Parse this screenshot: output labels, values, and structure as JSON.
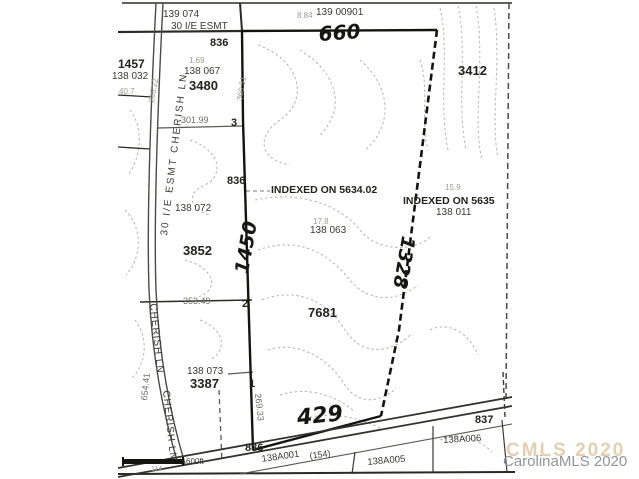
{
  "colors": {
    "ink": "#2b2b26",
    "faint_print": "#9b9b90",
    "contour": "#b4b4ab",
    "watermark_front": "#8f959c",
    "watermark_ghost": "#d0a769"
  },
  "watermark": {
    "ghost": "CMLS 2020",
    "front": "CarolinaMLS 2020"
  },
  "labels": {
    "tract_139_074": "139 074",
    "esmt_top": "30 I/E ESMT",
    "elev_836_top": "836",
    "dim_884": "8.84",
    "tract_139_00901": "139 00901",
    "parcel_1457": "1457",
    "tract_138_032": "138 032",
    "dim_40_7": "40.7",
    "dim_1_69": "1.69",
    "tract_138_067": "138 067",
    "parcel_3480": "3480",
    "parcel_3412": "3412",
    "dim_301_99": "301.99",
    "lot_3": "3",
    "elev_836_mid": "836",
    "indexed_5634": "INDEXED ON 5634.02",
    "dim_15_9": "15.9",
    "indexed_5635": "INDEXED ON 5635",
    "tract_138_011": "138 011",
    "tract_138_072": "138 072",
    "dim_17_8": "17.8",
    "tract_138_063": "138 063",
    "parcel_3852": "3852",
    "parcel_7681": "7681",
    "dim_353_49": "353.49",
    "lot_2": "2",
    "tract_138_073": "138 073",
    "parcel_3387": "3387",
    "lot_1": "1",
    "elev_836_bottom": "836",
    "hand_660": "660",
    "hand_1450": "1450",
    "hand_1328": "1328",
    "hand_429": "429",
    "road_esmt_cherish": "30 I/E ESMT CHERISH LN",
    "road_cherish_1": "CHERISH LN",
    "road_cherish_2": "CHERISH LN",
    "dim_654_41": "654.41",
    "dim_269_33": "269.33",
    "dim_206_22": "206.22",
    "dim_360_51": "360.51",
    "tract_138A001": "138A001",
    "dim_154": "(154)",
    "tract_138A005": "138A005",
    "tract_138A006": "138A006",
    "elev_837": "837",
    "scale_600": "600ft",
    "dim_114": "114"
  }
}
